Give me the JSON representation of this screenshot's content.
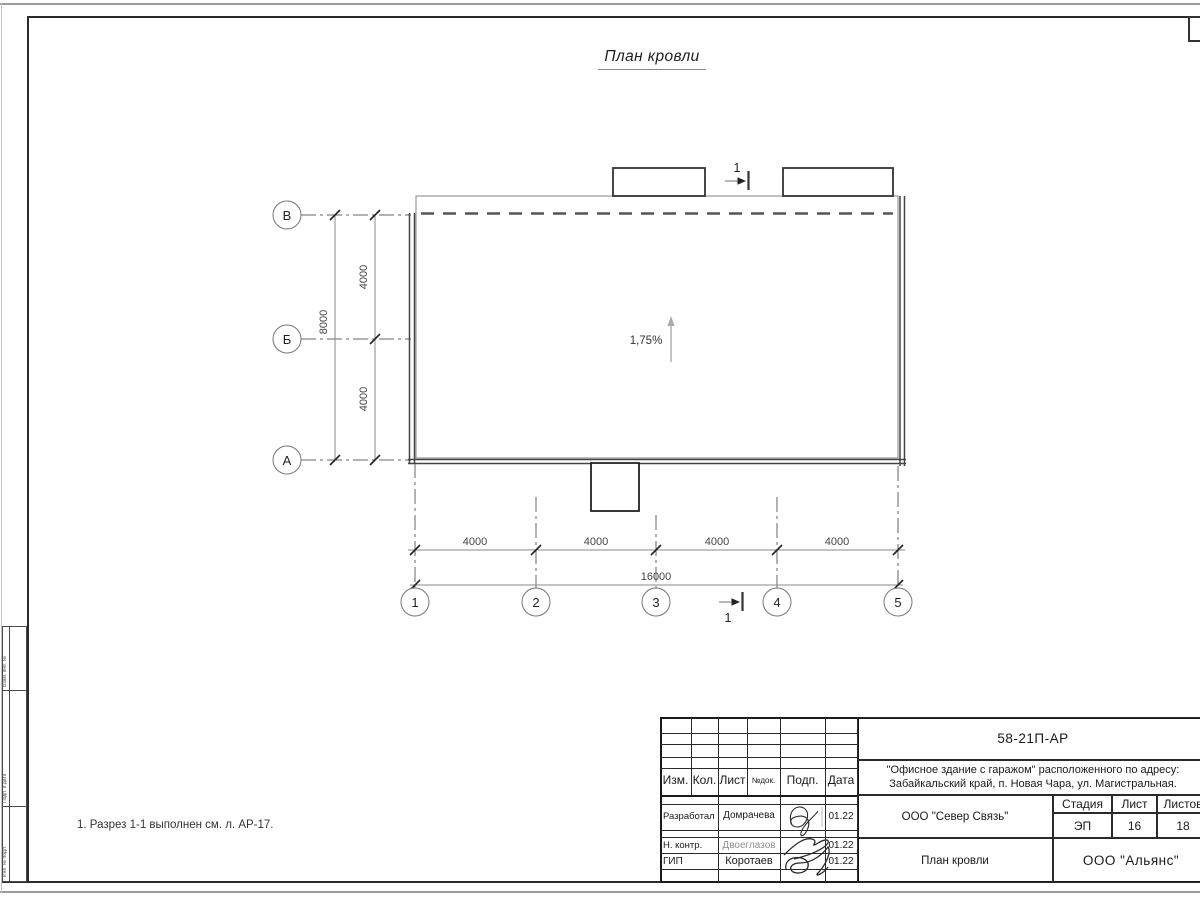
{
  "page": {
    "title": "План кровли",
    "note": "1. Разрез 1-1 выполнен см. л. АР-17."
  },
  "plan": {
    "slope_label": "1,75%",
    "section_top_label": "1",
    "section_bottom_label": "1",
    "row_axes": [
      "В",
      "Б",
      "А"
    ],
    "col_axes": [
      "1",
      "2",
      "3",
      "4",
      "5"
    ],
    "left_dims": {
      "inner": [
        "4000",
        "4000"
      ],
      "total": "8000"
    },
    "bottom_dims": {
      "inner": [
        "4000",
        "4000",
        "4000",
        "4000"
      ],
      "total": "16000"
    }
  },
  "side_strip": {
    "labels": [
      "Взам. инв. №",
      "Подп. и дата",
      "Инв. № подл."
    ]
  },
  "title_block": {
    "doc_number": "58-21П-АР",
    "object_line1": "\"Офисное здание с гаражом\" расположенного по адресу:",
    "object_line2": "Забайкальский край, п. Новая Чара, ул. Магистральная.",
    "header_cols": [
      "Изм.",
      "Кол.",
      "Лист",
      "№док.",
      "Подп.",
      "Дата"
    ],
    "rows": [
      {
        "role": "Разработал",
        "name": "Домрачева",
        "date": "01.22"
      },
      {
        "role": "Н. контр.",
        "name": "Двоеглазов",
        "date": "01.22"
      },
      {
        "role": "ГИП",
        "name": "Коротаев",
        "date": "01.22"
      }
    ],
    "contractor": "ООО \"Север Связь\"",
    "stage_header": [
      "Стадия",
      "Лист",
      "Листов"
    ],
    "stage_values": [
      "ЭП",
      "16",
      "18"
    ],
    "drawing_name": "План кровли",
    "company": "ООО \"Альянс\""
  }
}
